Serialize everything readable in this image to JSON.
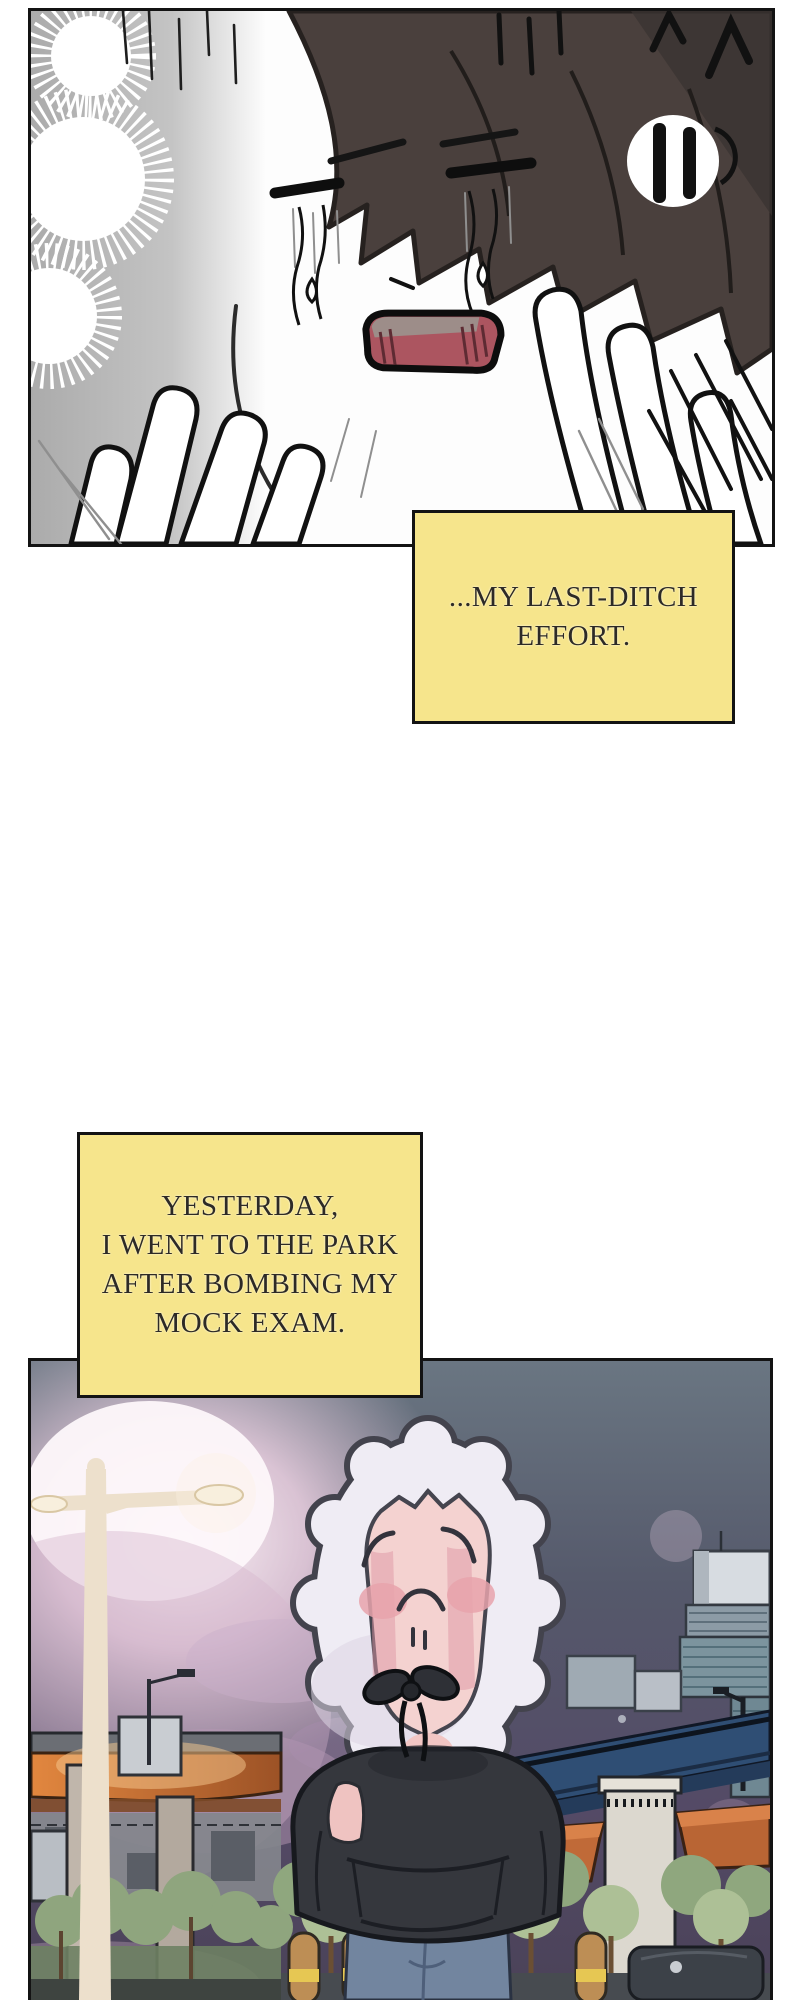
{
  "page": {
    "kind": "webtoon-episode-strip",
    "background": "#ffffff"
  },
  "captions": {
    "box1": {
      "lines": [
        "...MY LAST-DITCH",
        "EFFORT."
      ],
      "bg": "#F6E58C",
      "border_color": "#131313",
      "text_color": "#2D2A26"
    },
    "box2": {
      "lines": [
        "YESTERDAY,",
        "I WENT TO THE PARK",
        "AFTER BOMBING MY",
        "MOCK EXAM."
      ],
      "bg": "#F6E58C",
      "border_color": "#131313",
      "text_color": "#2D2A26"
    }
  },
  "panels": {
    "panel1": {
      "alt": "black-and-white close-up of a crying face, hands on cheeks"
    },
    "panel2": {
      "alt": "dusk park scene: hooded character, street lamp glow, overpass and city lights"
    }
  },
  "colors": {
    "panel_border": "#131313",
    "caption_yellow": "#F6E58C",
    "hair": "#4A403D",
    "mouth": "#AC5560",
    "sky_top": "#6A7682",
    "sky_bottom": "#4A4258",
    "glow_pink": "#FBF3F7",
    "lamp_cream": "#EDE0CC",
    "hood_white": "#EFECF4",
    "skin_pink": "#F4D2D0",
    "blush": "#E8A3AC",
    "hoodie_charcoal": "#35373D",
    "jeans_blue": "#72859F",
    "bridge_blue": "#2F4E74",
    "underpass_orange": "#D97A3C",
    "foliage_green": "#A3B78C",
    "bollard_tan": "#BD8E55"
  }
}
